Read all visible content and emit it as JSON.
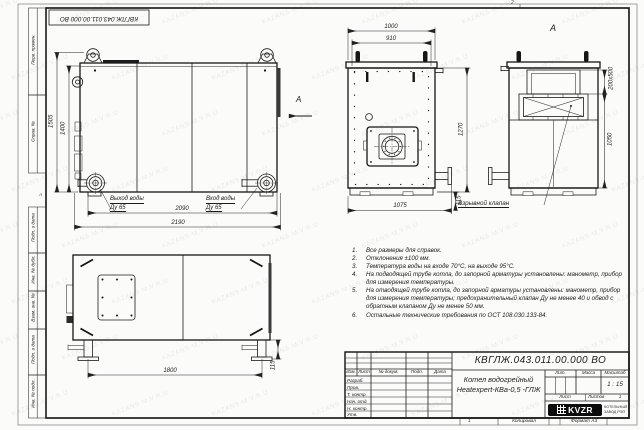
{
  "doc_number": "КВГЛЖ.043.011.00.000 ВО",
  "frame": {
    "margin_labels": {
      "perv": "Перв. примен.",
      "sprav": "Справ. №",
      "podp1": "Подп. и дата",
      "inv_dubl": "Инв. № дубл.",
      "vzam": "Взам. инв. №",
      "podp2": "Подп. и дата",
      "inv_podl": "Инв. № подл.",
      "zone_left": "А"
    },
    "zone_top": "2",
    "zone_bottom": "1",
    "copied": "Копировал",
    "format": "Формат А3"
  },
  "views": {
    "side": {
      "dims": {
        "h_total": "1505",
        "h_body": "1400",
        "w_inner": "2090",
        "w_total": "2190"
      },
      "outlet_line1": "Выход воды",
      "outlet_line2": "Ду 65",
      "inlet_line1": "Вход воды",
      "inlet_line2": "Ду 65",
      "view_arrow_label": "А"
    },
    "front": {
      "dims": {
        "w_top": "1000",
        "w_inner": "910",
        "h_right": "1270",
        "w_bottom": "1075",
        "h_pipe": "115"
      }
    },
    "viewA": {
      "title": "А",
      "dims": {
        "duct": "200х500",
        "h": "1050"
      },
      "valve_label": "Взрывной клапан"
    },
    "bottom": {
      "dims": {
        "w_legs": "1800",
        "h_foot": "115"
      }
    }
  },
  "notes": {
    "items": [
      {
        "n": "1.",
        "text": "Все размеры для справок."
      },
      {
        "n": "2.",
        "text": "Отклонения ±100 мм."
      },
      {
        "n": "3.",
        "text": "Температура воды на входе 70°С, на выходе 95°С."
      },
      {
        "n": "4.",
        "text": "На подводящей трубе котла, до запорной арматуры установлены: манометр, прибор для измерения температуры."
      },
      {
        "n": "5.",
        "text": "На отводящей трубе котла, до запорной арматуры установлены: манометр, прибор для измерения температуры; предохранительный клапан Ду не менее 40 и обвод с обратным клапаном Ду не менее 50 мм."
      },
      {
        "n": "6.",
        "text": "Остальные технические требования по ОСТ 108.030.133-84."
      }
    ]
  },
  "title_block": {
    "title_line1": "Котел водогрейный",
    "title_line2": "Heatexpert-КВа-0,5 -ГЛЖ",
    "cols": {
      "izm": "Изм.",
      "list": "Лист",
      "doc": "№ докум.",
      "podp": "Подп.",
      "data": "Дата"
    },
    "rows": {
      "razrab": "Разраб.",
      "prov": "Пров.",
      "tkontr": "Т. контр.",
      "nachotd": "Нач. отд.",
      "nkontr": "Н. контр.",
      "utv": "Утв."
    },
    "lit_label": "Лит.",
    "mass_label": "Масса",
    "scale_label": "Масштаб",
    "scale_value": "1 : 15",
    "sheet_label": "Лист",
    "sheets_label": "Листов",
    "sheets_value": "1",
    "logo_text": "KVZR",
    "company_line1": "КОТЕЛЬНЫЙ",
    "company_line2": "ЗАВОД РЭП"
  },
  "watermark": {
    "text": "KAZANS-M.V.R.U"
  }
}
